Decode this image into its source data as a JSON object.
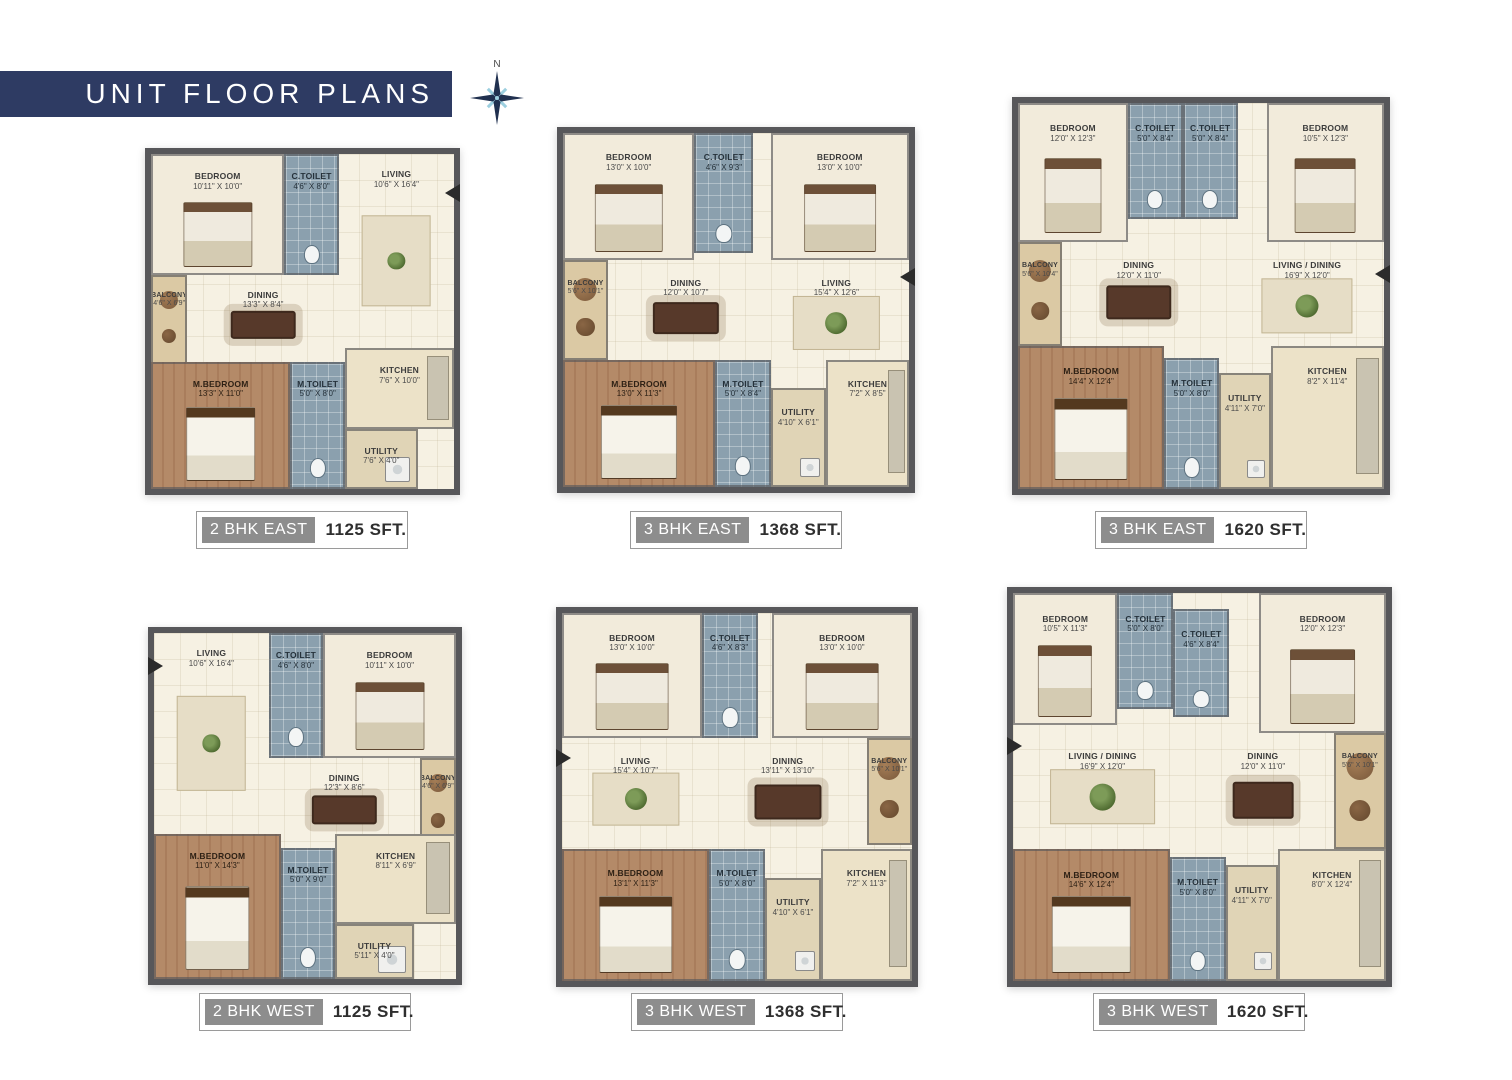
{
  "header": {
    "title": "UNIT FLOOR PLANS",
    "compass_label": "N"
  },
  "colors": {
    "banner": "#2e3b63",
    "wall": "#57575a",
    "floor": "#f6f1e3",
    "toilet": "#8ba0ae",
    "wood": "#b48a68",
    "balcony": "#dbc9a4",
    "kitchen": "#ece2c8",
    "badge": "#8d8d8d",
    "compass_dark": "#20304f",
    "compass_light": "#9ccfdf"
  },
  "plans": [
    {
      "id": "2-bhk-east",
      "badge": "2 BHK EAST",
      "area": "1125 SFT.",
      "entry": {
        "side": "right",
        "top": 9
      },
      "rooms": [
        {
          "name": "BEDROOM",
          "dims": "10'11\" X 10'0\"",
          "type": "bedroom",
          "rect": [
            0,
            0,
            44,
            36
          ]
        },
        {
          "name": "C.TOILET",
          "dims": "4'6\" X 8'0\"",
          "type": "toilet",
          "rect": [
            44,
            0,
            18,
            36
          ]
        },
        {
          "name": "LIVING",
          "dims": "10'6\" X 16'4\"",
          "type": "living",
          "rect": [
            62,
            0,
            38,
            58
          ]
        },
        {
          "name": "BALCONY",
          "dims": "4'6\" X 6'9\"",
          "type": "balcony",
          "rect": [
            0,
            36,
            12,
            28
          ]
        },
        {
          "name": "DINING",
          "dims": "13'3\" X 8'4\"",
          "type": "dining",
          "rect": [
            12,
            36,
            50,
            26
          ]
        },
        {
          "name": "M.BEDROOM",
          "dims": "13'3\" X 11'0\"",
          "type": "master",
          "rect": [
            0,
            62,
            46,
            38
          ]
        },
        {
          "name": "M.TOILET",
          "dims": "5'0\" X 8'0\"",
          "type": "toilet",
          "rect": [
            46,
            62,
            18,
            38
          ]
        },
        {
          "name": "KITCHEN",
          "dims": "7'6\" X 10'0\"",
          "type": "kitchen",
          "rect": [
            64,
            58,
            36,
            24
          ]
        },
        {
          "name": "UTILITY",
          "dims": "7'6\" X 4'0\"",
          "type": "utility",
          "rect": [
            64,
            82,
            24,
            18
          ]
        }
      ]
    },
    {
      "id": "3-bhk-east-1368",
      "badge": "3 BHK EAST",
      "area": "1368 SFT.",
      "entry": {
        "side": "right",
        "top": 38
      },
      "rooms": [
        {
          "name": "BEDROOM",
          "dims": "13'0\" X 10'0\"",
          "type": "bedroom",
          "rect": [
            0,
            0,
            38,
            36
          ]
        },
        {
          "name": "C.TOILET",
          "dims": "4'6\" X 9'3\"",
          "type": "toilet",
          "rect": [
            38,
            0,
            17,
            34
          ]
        },
        {
          "name": "BEDROOM",
          "dims": "13'0\" X 10'0\"",
          "type": "bedroom",
          "rect": [
            60,
            0,
            40,
            36
          ]
        },
        {
          "name": "BALCONY",
          "dims": "5'6\" X 10'1\"",
          "type": "balcony",
          "rect": [
            0,
            36,
            13,
            28
          ]
        },
        {
          "name": "DINING",
          "dims": "12'0\" X 10'7\"",
          "type": "dining",
          "rect": [
            13,
            36,
            45,
            28
          ]
        },
        {
          "name": "LIVING",
          "dims": "15'4\" X 12'6\"",
          "type": "living",
          "rect": [
            58,
            36,
            42,
            32
          ]
        },
        {
          "name": "M.BEDROOM",
          "dims": "13'0\" X 11'3\"",
          "type": "master",
          "rect": [
            0,
            64,
            44,
            36
          ]
        },
        {
          "name": "M.TOILET",
          "dims": "5'0\" X 8'4\"",
          "type": "toilet",
          "rect": [
            44,
            64,
            16,
            36
          ]
        },
        {
          "name": "UTILITY",
          "dims": "4'10\" X 6'1\"",
          "type": "utility",
          "rect": [
            60,
            72,
            16,
            28
          ]
        },
        {
          "name": "KITCHEN",
          "dims": "7'2\" X 8'5\"",
          "type": "kitchen",
          "rect": [
            76,
            64,
            24,
            36
          ]
        }
      ]
    },
    {
      "id": "3-bhk-east-1620",
      "badge": "3 BHK EAST",
      "area": "1620 SFT.",
      "entry": {
        "side": "right",
        "top": 42
      },
      "rooms": [
        {
          "name": "BEDROOM",
          "dims": "12'0\" X 12'3\"",
          "type": "bedroom",
          "rect": [
            0,
            0,
            30,
            36
          ]
        },
        {
          "name": "C.TOILET",
          "dims": "5'0\" X 8'4\"",
          "type": "toilet",
          "rect": [
            30,
            0,
            15,
            30
          ]
        },
        {
          "name": "C.TOILET",
          "dims": "5'0\" X 8'4\"",
          "type": "toilet",
          "rect": [
            45,
            0,
            15,
            30
          ]
        },
        {
          "name": "BEDROOM",
          "dims": "10'5\" X 12'3\"",
          "type": "bedroom",
          "rect": [
            68,
            0,
            32,
            36
          ]
        },
        {
          "name": "BALCONY",
          "dims": "5'6\" X 10'4\"",
          "type": "balcony",
          "rect": [
            0,
            36,
            12,
            27
          ]
        },
        {
          "name": "DINING",
          "dims": "12'0\" X 11'0\"",
          "type": "dining",
          "rect": [
            12,
            36,
            42,
            27
          ]
        },
        {
          "name": "LIVING / DINING",
          "dims": "16'9\" X 12'0\"",
          "type": "living",
          "rect": [
            58,
            36,
            42,
            30
          ]
        },
        {
          "name": "M.BEDROOM",
          "dims": "14'4\" X 12'4\"",
          "type": "master",
          "rect": [
            0,
            63,
            40,
            37
          ]
        },
        {
          "name": "M.TOILET",
          "dims": "5'0\" X 8'0\"",
          "type": "toilet",
          "rect": [
            40,
            66,
            15,
            34
          ]
        },
        {
          "name": "UTILITY",
          "dims": "4'11\" X 7'0\"",
          "type": "utility",
          "rect": [
            55,
            70,
            14,
            30
          ]
        },
        {
          "name": "KITCHEN",
          "dims": "8'2\" X 11'4\"",
          "type": "kitchen",
          "rect": [
            69,
            63,
            31,
            37
          ]
        }
      ]
    },
    {
      "id": "2-bhk-west",
      "badge": "2 BHK WEST",
      "area": "1125 SFT.",
      "entry": {
        "side": "left",
        "top": 7
      },
      "rooms": [
        {
          "name": "LIVING",
          "dims": "10'6\" X 16'4\"",
          "type": "living",
          "rect": [
            0,
            0,
            38,
            58
          ]
        },
        {
          "name": "C.TOILET",
          "dims": "4'6\" X 8'0\"",
          "type": "toilet",
          "rect": [
            38,
            0,
            18,
            36
          ]
        },
        {
          "name": "BEDROOM",
          "dims": "10'11\" X 10'0\"",
          "type": "bedroom",
          "rect": [
            56,
            0,
            44,
            36
          ]
        },
        {
          "name": "DINING",
          "dims": "12'3\" X 8'6\"",
          "type": "dining",
          "rect": [
            38,
            36,
            50,
            26
          ]
        },
        {
          "name": "BALCONY",
          "dims": "4'6\" X 6'9\"",
          "type": "balcony",
          "rect": [
            88,
            36,
            12,
            28
          ]
        },
        {
          "name": "M.BEDROOM",
          "dims": "11'0\" X 14'3\"",
          "type": "master",
          "rect": [
            0,
            58,
            42,
            42
          ]
        },
        {
          "name": "M.TOILET",
          "dims": "5'0\" X 9'0\"",
          "type": "toilet",
          "rect": [
            42,
            62,
            18,
            38
          ]
        },
        {
          "name": "KITCHEN",
          "dims": "8'11\" X 6'9\"",
          "type": "kitchen",
          "rect": [
            60,
            58,
            40,
            26
          ]
        },
        {
          "name": "UTILITY",
          "dims": "5'11\" X 4'0\"",
          "type": "utility",
          "rect": [
            60,
            84,
            26,
            16
          ]
        }
      ]
    },
    {
      "id": "3-bhk-west-1368",
      "badge": "3 BHK WEST",
      "area": "1368 SFT.",
      "entry": {
        "side": "left",
        "top": 37
      },
      "rooms": [
        {
          "name": "BEDROOM",
          "dims": "13'0\" X 10'0\"",
          "type": "bedroom",
          "rect": [
            0,
            0,
            40,
            34
          ]
        },
        {
          "name": "C.TOILET",
          "dims": "4'6\" X 8'3\"",
          "type": "toilet",
          "rect": [
            40,
            0,
            16,
            34
          ]
        },
        {
          "name": "BEDROOM",
          "dims": "13'0\" X 10'0\"",
          "type": "bedroom",
          "rect": [
            60,
            0,
            40,
            34
          ]
        },
        {
          "name": "LIVING",
          "dims": "15'4\" X 10'7\"",
          "type": "living",
          "rect": [
            0,
            34,
            42,
            30
          ]
        },
        {
          "name": "DINING",
          "dims": "13'11\" X 13'10\"",
          "type": "dining",
          "rect": [
            42,
            34,
            45,
            30
          ]
        },
        {
          "name": "BALCONY",
          "dims": "5'6\" X 10'1\"",
          "type": "balcony",
          "rect": [
            87,
            34,
            13,
            29
          ]
        },
        {
          "name": "M.BEDROOM",
          "dims": "13'1\" X 11'3\"",
          "type": "master",
          "rect": [
            0,
            64,
            42,
            36
          ]
        },
        {
          "name": "M.TOILET",
          "dims": "5'0\" X 8'0\"",
          "type": "toilet",
          "rect": [
            42,
            64,
            16,
            36
          ]
        },
        {
          "name": "UTILITY",
          "dims": "4'10\" X 6'1\"",
          "type": "utility",
          "rect": [
            58,
            72,
            16,
            28
          ]
        },
        {
          "name": "KITCHEN",
          "dims": "7'2\" X 11'3\"",
          "type": "kitchen",
          "rect": [
            74,
            64,
            26,
            36
          ]
        }
      ]
    },
    {
      "id": "3-bhk-west-1620",
      "badge": "3 BHK WEST",
      "area": "1620 SFT.",
      "entry": {
        "side": "left",
        "top": 37
      },
      "rooms": [
        {
          "name": "BEDROOM",
          "dims": "10'5\" X 11'3\"",
          "type": "bedroom",
          "rect": [
            0,
            0,
            28,
            34
          ]
        },
        {
          "name": "C.TOILET",
          "dims": "5'0\" X 8'0\"",
          "type": "toilet",
          "rect": [
            28,
            0,
            15,
            30
          ]
        },
        {
          "name": "C.TOILET",
          "dims": "4'6\" X 8'4\"",
          "type": "toilet",
          "rect": [
            43,
            4,
            15,
            28
          ]
        },
        {
          "name": "BEDROOM",
          "dims": "12'0\" X 12'3\"",
          "type": "bedroom",
          "rect": [
            66,
            0,
            34,
            36
          ]
        },
        {
          "name": "LIVING / DINING",
          "dims": "16'9\" X 12'0\"",
          "type": "living",
          "rect": [
            0,
            36,
            48,
            30
          ]
        },
        {
          "name": "DINING",
          "dims": "12'0\" X 11'0\"",
          "type": "dining",
          "rect": [
            48,
            36,
            38,
            30
          ]
        },
        {
          "name": "BALCONY",
          "dims": "5'6\" X 10'1\"",
          "type": "balcony",
          "rect": [
            86,
            36,
            14,
            30
          ]
        },
        {
          "name": "M.BEDROOM",
          "dims": "14'6\" X 12'4\"",
          "type": "master",
          "rect": [
            0,
            66,
            42,
            34
          ]
        },
        {
          "name": "M.TOILET",
          "dims": "5'0\" X 8'0\"",
          "type": "toilet",
          "rect": [
            42,
            68,
            15,
            32
          ]
        },
        {
          "name": "UTILITY",
          "dims": "4'11\" X 7'0\"",
          "type": "utility",
          "rect": [
            57,
            70,
            14,
            30
          ]
        },
        {
          "name": "KITCHEN",
          "dims": "8'0\" X 12'4\"",
          "type": "kitchen",
          "rect": [
            71,
            66,
            29,
            34
          ]
        }
      ]
    }
  ]
}
